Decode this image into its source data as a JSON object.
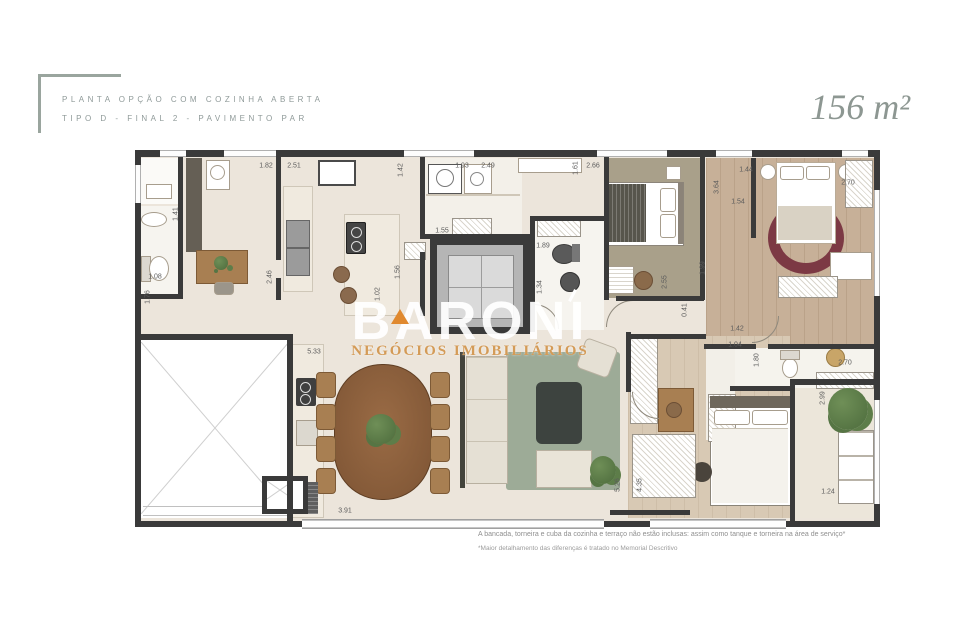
{
  "header": {
    "title_line1": "PLANTA OPÇÃO COM COZINHA ABERTA",
    "title_line2": "TIPO D - FINAL 2 - PAVIMENTO PAR",
    "area": "156 m²"
  },
  "watermark": {
    "brand": "BARONI",
    "subtitle": "NEGÓCIOS IMOBILIÁRIOS"
  },
  "footer": {
    "note1": "A bancada, torneira e cuba da cozinha e terraço não estão inclusas: assim como tanque e torneira na área de serviço*",
    "note2": "*Maior detalhamento das diferenças é tratado no Memorial Descritivo"
  },
  "colors": {
    "wall": "#3a3a3a",
    "floor_beige": "#ece5db",
    "floor_wood": "#c7b098",
    "floor_wood_light": "#d8c9b4",
    "floor_olive": "#a9a08a",
    "rug_green": "#9dab97",
    "rug_red": "#7c3944",
    "accent_green": "#9aa59e",
    "accent_orange": "#e0892f",
    "watermark_sub": "#d49b57"
  },
  "plan": {
    "dimensions": [
      {
        "t": "1.82",
        "x": 266,
        "y": 166
      },
      {
        "t": "2.51",
        "x": 294,
        "y": 166
      },
      {
        "t": "1.93",
        "x": 462,
        "y": 166
      },
      {
        "t": "2.49",
        "x": 488,
        "y": 166
      },
      {
        "t": "2.66",
        "x": 593,
        "y": 166
      },
      {
        "t": "1.44",
        "x": 746,
        "y": 170
      },
      {
        "t": "2.70",
        "x": 848,
        "y": 183
      },
      {
        "t": "1.54",
        "x": 738,
        "y": 202
      },
      {
        "t": "1.55",
        "x": 442,
        "y": 231
      },
      {
        "t": "1.89",
        "x": 543,
        "y": 246
      },
      {
        "t": "1.08",
        "x": 155,
        "y": 277
      },
      {
        "t": "5.33",
        "x": 314,
        "y": 352
      },
      {
        "t": "1.42",
        "x": 737,
        "y": 329
      },
      {
        "t": "1.04",
        "x": 735,
        "y": 345
      },
      {
        "t": "2.70",
        "x": 845,
        "y": 363
      },
      {
        "t": "1.24",
        "x": 828,
        "y": 492
      },
      {
        "t": "3.91",
        "x": 345,
        "y": 511
      },
      {
        "t": "1.42",
        "x": 401,
        "y": 170,
        "v": 1
      },
      {
        "t": "1.61",
        "x": 576,
        "y": 168,
        "v": 1
      },
      {
        "t": "3.64",
        "x": 717,
        "y": 187,
        "v": 1
      },
      {
        "t": "1.41",
        "x": 176,
        "y": 214,
        "v": 1
      },
      {
        "t": "1.56",
        "x": 398,
        "y": 272,
        "v": 1
      },
      {
        "t": "1.34",
        "x": 540,
        "y": 287,
        "v": 1
      },
      {
        "t": "2.46",
        "x": 270,
        "y": 277,
        "v": 1
      },
      {
        "t": "1.02",
        "x": 378,
        "y": 294,
        "v": 1
      },
      {
        "t": "1.76",
        "x": 148,
        "y": 297,
        "v": 1
      },
      {
        "t": "2.55",
        "x": 665,
        "y": 282,
        "v": 1
      },
      {
        "t": "0.41",
        "x": 685,
        "y": 310,
        "v": 1
      },
      {
        "t": "1.99",
        "x": 703,
        "y": 268,
        "v": 1
      },
      {
        "t": "1.80",
        "x": 757,
        "y": 360,
        "v": 1
      },
      {
        "t": "2.99",
        "x": 823,
        "y": 398,
        "v": 1
      },
      {
        "t": "5.26",
        "x": 618,
        "y": 485,
        "v": 1
      },
      {
        "t": "4.35",
        "x": 640,
        "y": 485,
        "v": 1
      }
    ]
  }
}
